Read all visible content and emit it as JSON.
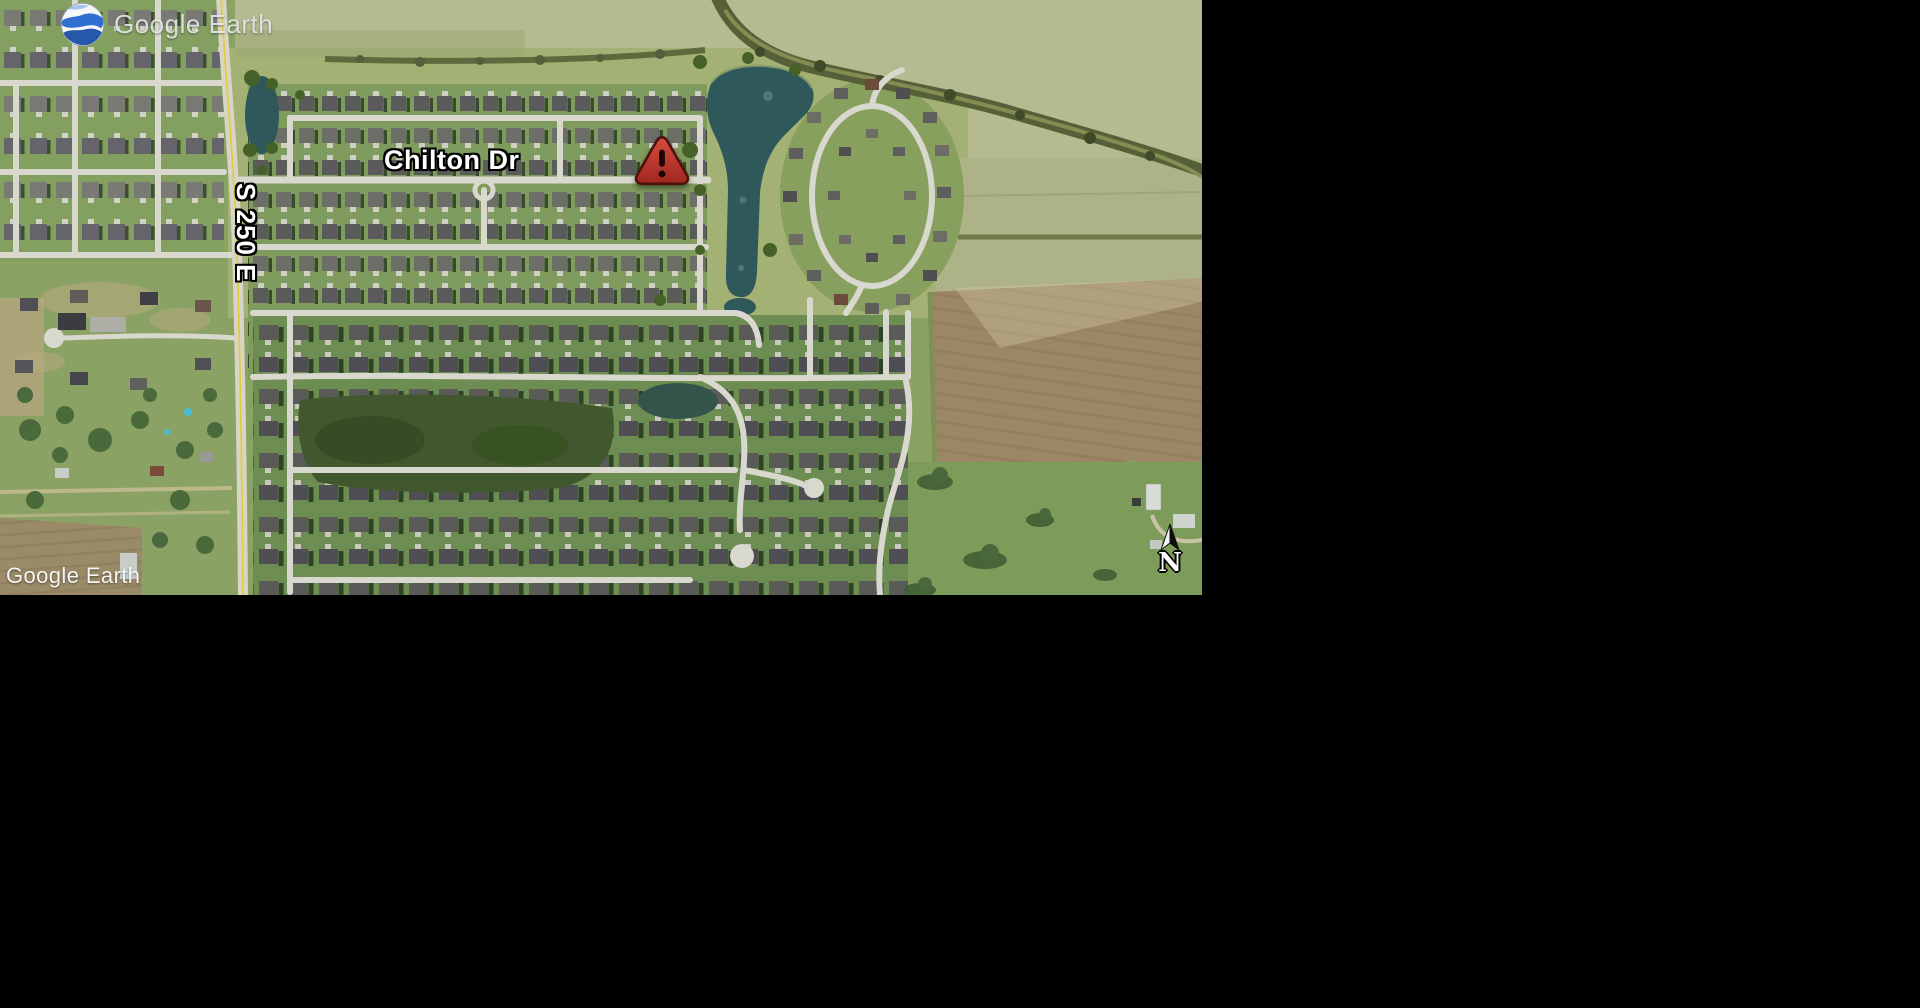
{
  "app": {
    "title": "Google Earth"
  },
  "map": {
    "logo": {
      "icon": "google-earth-globe-icon",
      "text": "Google Earth"
    },
    "labels": {
      "street_main": "Chilton Dr",
      "street_cross": "S 250 E"
    },
    "marker": {
      "kind": "warning-alert",
      "glyph": "!"
    },
    "compass": {
      "north_label": "N"
    },
    "watermark": {
      "text": "Google Earth"
    },
    "colors": {
      "grass": "#8ba265",
      "field_pale": "#b6ba90",
      "meadow": "#a4b175",
      "field_olive": "#adb287",
      "field_brown": "#9b8766",
      "pasture": "#7e9c59",
      "woods": "#41582f",
      "pond": "#2f585a",
      "pond_dark": "#33544b",
      "road": "#d9d8cf",
      "road_yellow": "#e3cd45",
      "creek": "#566038",
      "marker_red": "#c53a31",
      "marker_border": "#4e120d",
      "logo_blue": "#2f6fc1"
    }
  }
}
